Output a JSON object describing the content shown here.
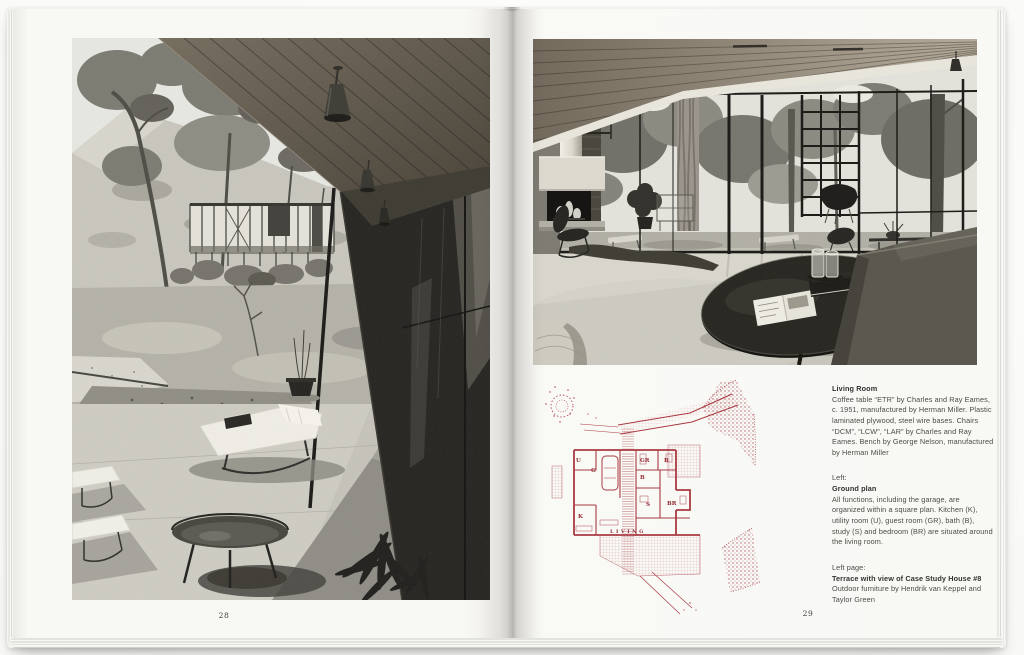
{
  "book": {
    "left_page": {
      "folio": "28"
    },
    "right_page": {
      "folio": "29",
      "captions": {
        "living_room": {
          "heading": "Living Room",
          "body": "Coffee table “ETR” by Charles and Ray Eames, c. 1951, manufactured by Herman Miller. Plastic laminated plywood, steel wire bases. Chairs “DCM”, “LCW”, “LAR” by Charles and Ray Eames. Bench by George Nelson, manufactured by Herman Miller"
        },
        "ground_plan": {
          "intro": "Left:",
          "heading": "Ground plan",
          "body": "All functions, including the garage, are organized within a square plan. Kitchen (K), utility room (U), guest room (GR), bath (B), study (S) and bedroom (BR) are situated around the living room."
        },
        "left_page_ref": {
          "intro": "Left page:",
          "heading": "Terrace with view of Case Study House #8",
          "body": "Outdoor furniture by Hendrik van Keppel and Taylor Green"
        }
      },
      "plan_labels": {
        "u": "U",
        "g": "G",
        "gr": "GR",
        "b_top": "B",
        "b_mid": "B",
        "s": "S",
        "br": "BR",
        "k": "K",
        "living": "LIVING"
      },
      "colors": {
        "plan_ink": "#a93b42"
      }
    }
  }
}
